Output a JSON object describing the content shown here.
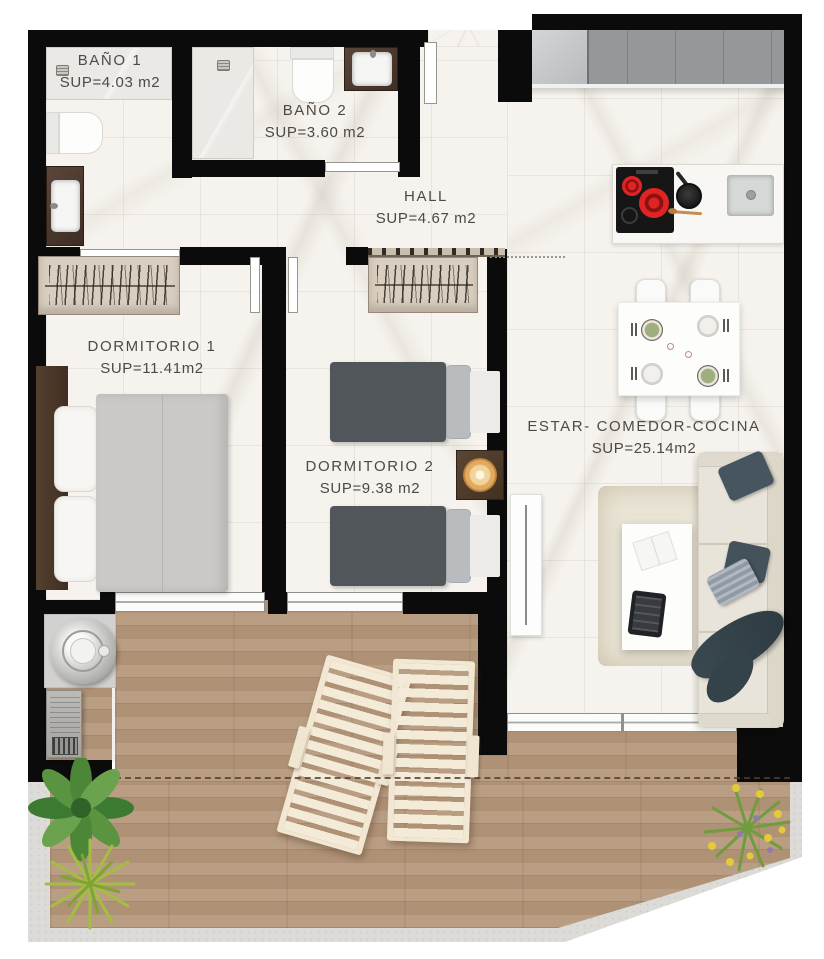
{
  "plan": {
    "type": "apartment-floor-plan"
  },
  "rooms": [
    {
      "id": "bano-1",
      "name": "BAÑO 1",
      "area": "SUP=4.03 m2"
    },
    {
      "id": "bano-2",
      "name": "BAÑO 2",
      "area": "SUP=3.60 m2"
    },
    {
      "id": "hall",
      "name": "HALL",
      "area": "SUP=4.67 m2"
    },
    {
      "id": "dormitorio-1",
      "name": "DORMITORIO 1",
      "area": "SUP=11.41m2"
    },
    {
      "id": "dormitorio-2",
      "name": "DORMITORIO 2",
      "area": "SUP=9.38 m2"
    },
    {
      "id": "estar-comedor-cocina",
      "name": "ESTAR- COMEDOR-COCINA",
      "area": "SUP=25.14m2"
    }
  ],
  "palette": {
    "wall": "#0b0b0b",
    "marble_floor": "#f6f3ee",
    "wood_deck": "#b5987c",
    "concrete": "#dcdbd7",
    "burner_red": "#d81f1f",
    "lamp_glow": "#e2a95f",
    "plant_green": "#55943e",
    "plant_yellow": "#e4ca36"
  }
}
